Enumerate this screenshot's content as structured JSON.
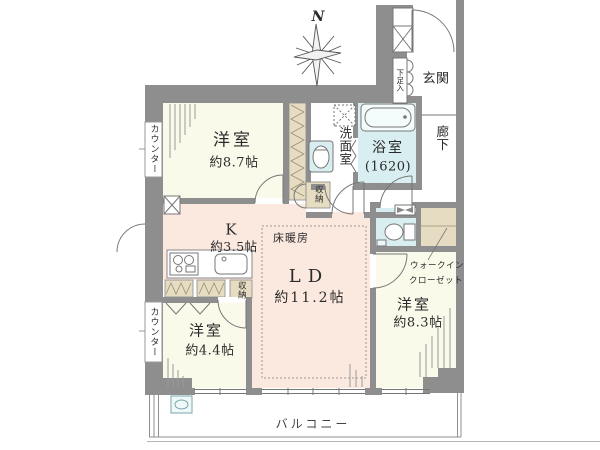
{
  "plan": {
    "compass_north": "N",
    "bedroom_87": {
      "name": "洋室",
      "size": "約8.7帖"
    },
    "bedroom_44": {
      "name": "洋室",
      "size": "約4.4帖"
    },
    "bedroom_83": {
      "name": "洋室",
      "size": "約8.3帖"
    },
    "living_dining": {
      "name": "LD",
      "size": "約11.2帖"
    },
    "kitchen": {
      "name": "K",
      "size": "約3.5帖"
    },
    "bathroom": {
      "name": "浴室",
      "size": "(1620)"
    },
    "washroom": {
      "name": "洗面室"
    },
    "entrance": {
      "name": "玄関"
    },
    "hallway": {
      "name": "廊下"
    },
    "shoe_cabinet": {
      "name": "下足入"
    },
    "walk_in_closet": {
      "line1": "ウォークイン",
      "line2": "クローゼット"
    },
    "floor_heating": {
      "name": "床暖房"
    },
    "storage_hall": {
      "name": "収納"
    },
    "storage_kitchen": {
      "name": "収納"
    },
    "counter_upper": {
      "name": "カウンター"
    },
    "counter_lower": {
      "name": "カウンター"
    },
    "balcony": {
      "name": "バルコニー"
    }
  },
  "colors": {
    "wall": "#8e8e8e",
    "bedroom_floor": "#fafaeb",
    "living_floor": "#fbe9e0",
    "wet_floor": "#d9eef0",
    "closet_fill": "#e6dcc2",
    "outline": "#777777"
  }
}
